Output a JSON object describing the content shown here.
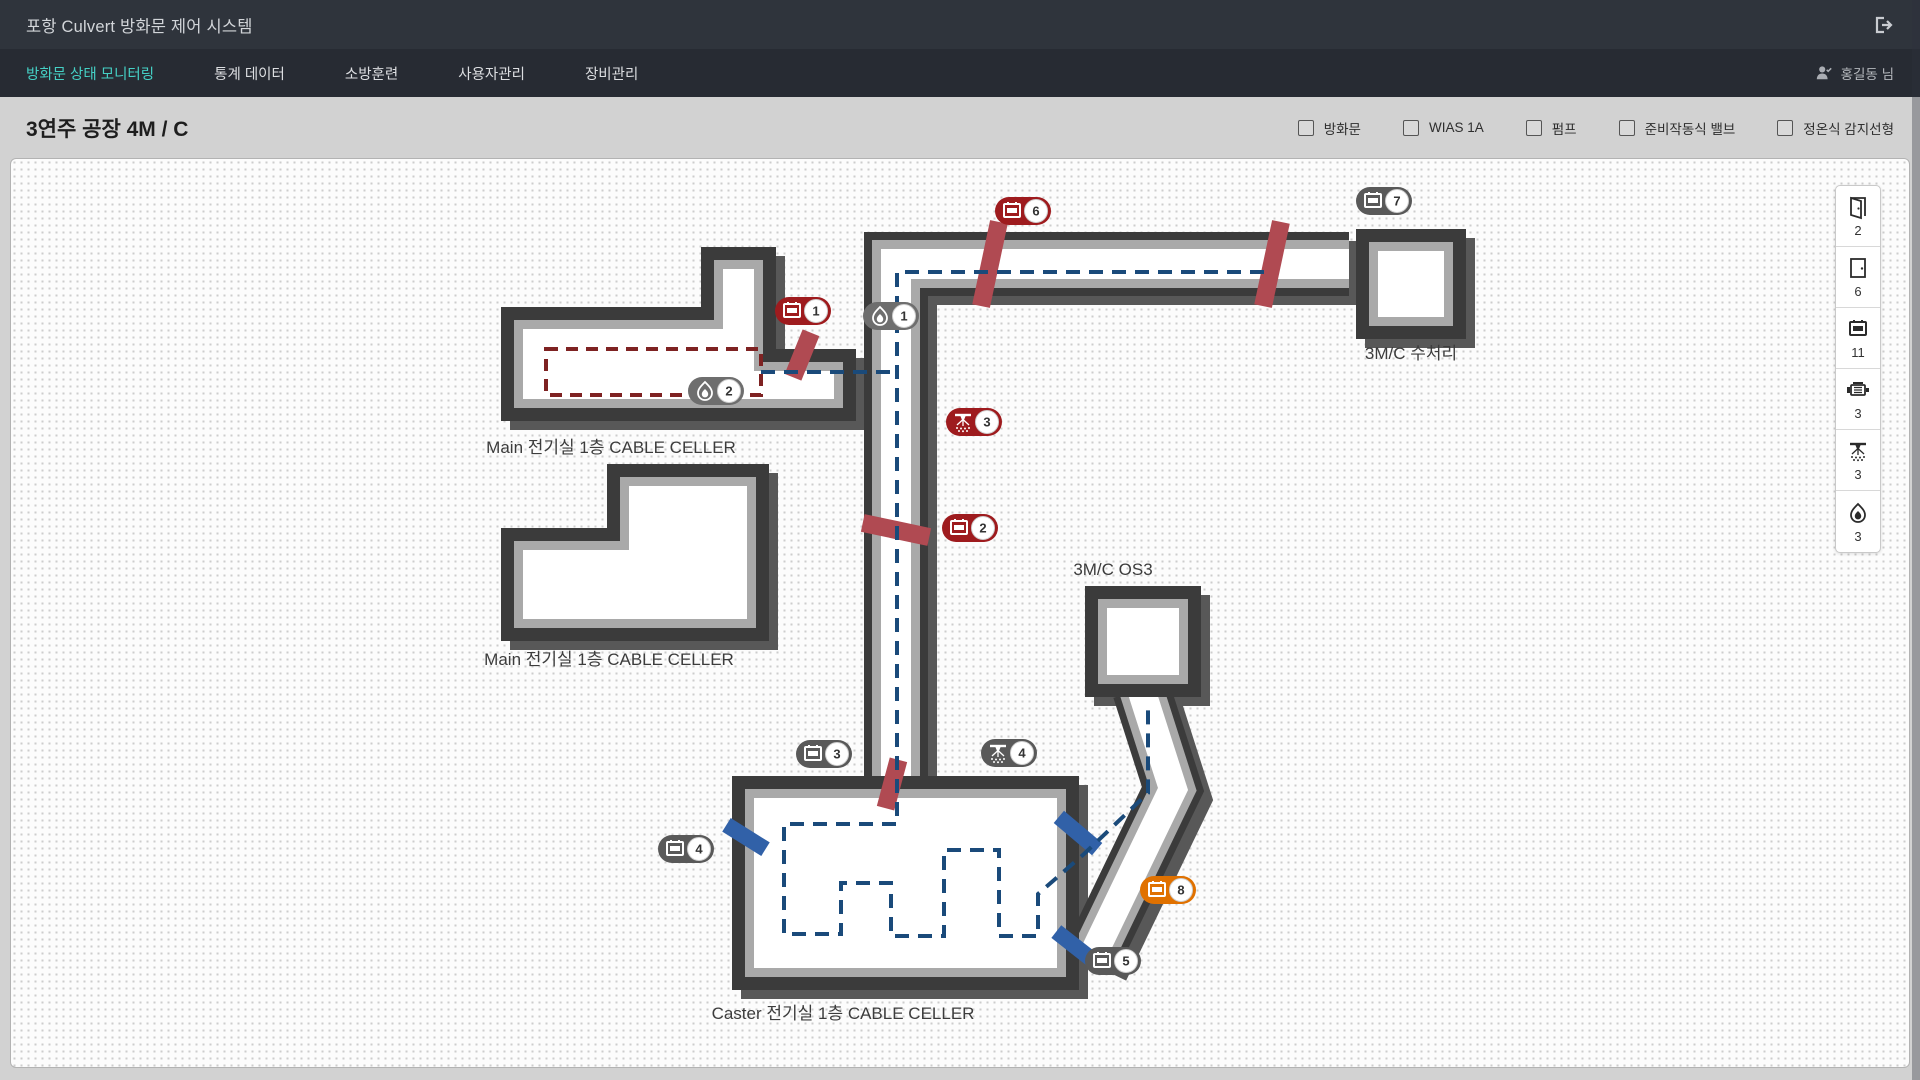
{
  "app": {
    "title": "포항 Culvert 방화문 제어 시스템"
  },
  "nav": {
    "tabs": [
      {
        "label": "방화문 상태 모니터링",
        "active": true
      },
      {
        "label": "통계 데이터",
        "active": false
      },
      {
        "label": "소방훈련",
        "active": false
      },
      {
        "label": "사용자관리",
        "active": false
      },
      {
        "label": "장비관리",
        "active": false
      }
    ],
    "user": "홍길동 님"
  },
  "page": {
    "title": "3연주 공장 4M / C"
  },
  "filters": [
    {
      "label": "방화문",
      "checked": false
    },
    {
      "label": "WIAS 1A",
      "checked": false
    },
    {
      "label": "펌프",
      "checked": false
    },
    {
      "label": "준비작동식 밸브",
      "checked": false
    },
    {
      "label": "정온식 감지선형",
      "checked": false
    }
  ],
  "colors": {
    "accent_teal": "#45d0c5",
    "status_alarm_red": "#9e1b1e",
    "status_normal_gray": "#595959",
    "status_detector_gray": "#6e6e6e",
    "status_warning_orange": "#e07100",
    "route_navy": "#1a4a7a",
    "route_dark_red": "#7e2222",
    "fire_door_red": "#b04a52",
    "door_blue": "#3161a8"
  },
  "legend": {
    "items": [
      {
        "icon": "door-open",
        "count": "2"
      },
      {
        "icon": "door-closed",
        "count": "6"
      },
      {
        "icon": "damper-panel",
        "count": "11"
      },
      {
        "icon": "pump",
        "count": "3"
      },
      {
        "icon": "sprinkler",
        "count": "3"
      },
      {
        "icon": "flame",
        "count": "3"
      }
    ]
  },
  "map": {
    "labels": [
      {
        "text": "Main 전기실 1층 CABLE CELLER",
        "x": 600,
        "y": 294
      },
      {
        "text": "Main 전기실 1층 CABLE CELLER",
        "x": 598,
        "y": 506
      },
      {
        "text": "Caster 전기실 1층 CABLE CELLER",
        "x": 832,
        "y": 860
      },
      {
        "text": "3M/C 수처리",
        "x": 1400,
        "y": 200
      },
      {
        "text": "3M/C OS3",
        "x": 1102,
        "y": 416
      }
    ],
    "markers": [
      {
        "icon": "damper-panel",
        "num": "6",
        "status": "alarm",
        "x": 1012,
        "y": 52
      },
      {
        "icon": "damper-panel",
        "num": "7",
        "status": "normal",
        "x": 1373,
        "y": 42
      },
      {
        "icon": "damper-panel",
        "num": "1",
        "status": "alarm",
        "x": 792,
        "y": 152
      },
      {
        "icon": "flame",
        "num": "1",
        "status": "detector",
        "x": 880,
        "y": 157
      },
      {
        "icon": "flame",
        "num": "2",
        "status": "detector",
        "x": 705,
        "y": 232
      },
      {
        "icon": "sprinkler",
        "num": "3",
        "status": "alarm",
        "x": 963,
        "y": 263
      },
      {
        "icon": "damper-panel",
        "num": "2",
        "status": "alarm",
        "x": 959,
        "y": 369
      },
      {
        "icon": "damper-panel",
        "num": "3",
        "status": "normal",
        "x": 813,
        "y": 595
      },
      {
        "icon": "sprinkler",
        "num": "4",
        "status": "normal",
        "x": 998,
        "y": 594
      },
      {
        "icon": "damper-panel",
        "num": "4",
        "status": "normal",
        "x": 675,
        "y": 690
      },
      {
        "icon": "damper-panel",
        "num": "8",
        "status": "warning",
        "x": 1157,
        "y": 731
      },
      {
        "icon": "damper-panel",
        "num": "5",
        "status": "normal",
        "x": 1102,
        "y": 802
      }
    ]
  }
}
